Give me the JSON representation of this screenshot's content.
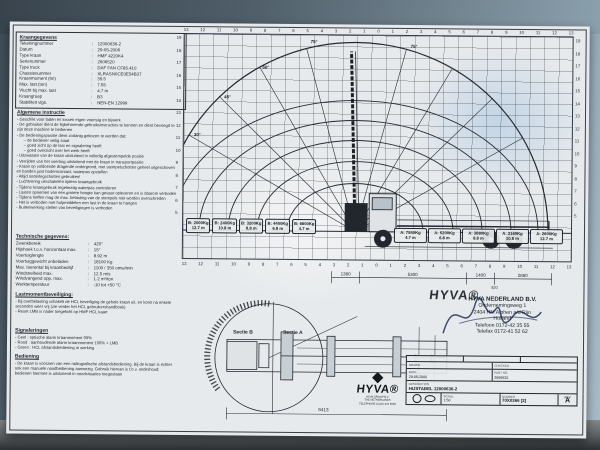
{
  "sheet": {
    "kraangegevens": {
      "title": "Kraangegevens",
      "rows": [
        {
          "label": "Tekeningnummer",
          "value": "12000636-2"
        },
        {
          "label": "Datum",
          "value": "29-05-2006"
        },
        {
          "label": "Type kraan",
          "value": "HMF 4220K4"
        },
        {
          "label": "Serienummer",
          "value": "2606520"
        },
        {
          "label": "Type truck",
          "value": "DAF FAN CF85.410"
        },
        {
          "label": "Chassisnummer",
          "value": "XLRASN0CE0E54B37"
        },
        {
          "label": "Kraanmoment (tm)",
          "value": "35.5"
        },
        {
          "label": "Max. last (ton)",
          "value": "7.55"
        },
        {
          "label": "Vlucht bij max. last",
          "value": "4.7 m"
        },
        {
          "label": "Kraangroep",
          "value": "B3"
        },
        {
          "label": "Stabiliteit vlgs.",
          "value": "NEN-EN 12999"
        }
      ]
    },
    "algemene_instructie": {
      "title": "Algemene instructie",
      "items": [
        {
          "text": "Geschikt voor laden en lossen eigen voertuig en bijwerk",
          "sub": false
        },
        {
          "text": "De gebruiker dient de bijbehorende gebruiksinstructies te kennen en dient bevoegd te zijn deze machine te bedienen",
          "sub": false
        },
        {
          "text": "De bedieningspositie dient zodanig gekozen te worden dat:",
          "sub": false
        },
        {
          "text": "de bediener veilig staat",
          "sub": true
        },
        {
          "text": "goed zicht op de last en signalering heeft",
          "sub": true
        },
        {
          "text": "goed overzicht over het werk heeft",
          "sub": true
        },
        {
          "text": "Uitzwaaien van de kraan uitsluitend in volledig afgestempelde positie",
          "sub": false
        },
        {
          "text": "Verrijden van het voertuig uitsluitend met de kraan in transportpositie",
          "sub": false
        },
        {
          "text": "Kraan op voldoende dragende ondergrond, met stempelschotten geheel uitgeschoven en banden juist bodemcontact, waterpas opstellen",
          "sub": false
        },
        {
          "text": "Altijd onderlegschotten gebruiken!",
          "sub": false
        },
        {
          "text": "Luchtvering uitschakelen tijdens kraangebruik",
          "sub": false
        },
        {
          "text": "Tijdens kraangebruik regelmatig waterpas controleren",
          "sub": false
        },
        {
          "text": "Lasten opnemen van een grotere hoogte kan gevaar opleveren en is daarom verboden",
          "sub": false
        },
        {
          "text": "Tijdens heffen mag de max. belasting van de stempels niet worden overschreden",
          "sub": false
        },
        {
          "text": "Het is verboden met hulpmiddelen een last in de kraan te hangen",
          "sub": false
        },
        {
          "text": "Buitenwerking stellen van beveiligingen is verboden",
          "sub": false
        }
      ]
    },
    "technische_gegevens": {
      "title": "Technische gegevens:",
      "rows": [
        {
          "label": "Zwenkbereik",
          "value": "420°"
        },
        {
          "label": "Hijshoek t.o.v. horizontaal max.",
          "value": "15°"
        },
        {
          "label": "Voertuiglengte",
          "value": "8.92 m"
        },
        {
          "label": "Voertuiggewicht onbeladen",
          "value": "18100 Kg"
        },
        {
          "label": "Max. toerental bij kraanbedrijf",
          "value": "1100 / 350 omw/min"
        },
        {
          "label": "Windsnelheid max.",
          "value": "12.5 m/s"
        },
        {
          "label": "Windvangend opp. max.",
          "value": "1.2 m²/ton"
        },
        {
          "label": "Werktemperatuur",
          "value": "-10 tot +50 °C"
        }
      ]
    },
    "lastmoment": {
      "title": "Lastmomentbeveiliging:",
      "items": [
        {
          "text": "Bij overbelasting schakelt de HCL beveiliging de gehele kraan uit, en komt na enkele seconden weer vrij (zie verder het HCL gebruikershandboek)",
          "sub": false
        },
        {
          "text": "Reset LMB is nader toegelicht op HMF HCL kaart",
          "sub": false
        }
      ]
    },
    "signaleringen": {
      "title": "Signaleringen",
      "items": [
        {
          "text": "Geel : optische alarm kraanmoment 90%",
          "sub": false
        },
        {
          "text": "Rood : aanhoudende alarm kraanmoment 100% + LMB",
          "sub": false
        },
        {
          "text": "Groen : HCL afstandsbediening in werking",
          "sub": false
        }
      ]
    },
    "bediening": {
      "title": "Bediening",
      "items": [
        {
          "text": "De kraan is voorzien van een radiografische afstandsbediening. Bij de kraan is echter ook een manuele noodbediening aanwezig. Gebruik hiervan is t.b.v. onderhoud; bedienen hiermee is uitsluitend in noodsituaties toegestaan",
          "sub": false
        }
      ]
    },
    "chart": {
      "scale_x": [
        "13",
        "12",
        "11",
        "10",
        "9",
        "8",
        "7",
        "6",
        "5",
        "4",
        "3",
        "2",
        "1",
        "0",
        "1",
        "2",
        "3",
        "4",
        "5",
        "6",
        "7",
        "8",
        "9",
        "10",
        "11",
        "12",
        "13"
      ],
      "scale_y": [
        "19",
        "18",
        "17",
        "16",
        "15",
        "14",
        "13",
        "12",
        "11",
        "10",
        "9",
        "8",
        "7",
        "6",
        "5"
      ],
      "angle_labels": [
        "30°",
        "45°",
        "60°",
        "75°",
        "75°"
      ],
      "capacity_b": [
        {
          "load": "B: 2000Kg",
          "reach": "12.7 m"
        },
        {
          "load": "B: 2400Kg",
          "reach": "10.8 m"
        },
        {
          "load": "B: 3200Kg",
          "reach": "8.8 m"
        },
        {
          "load": "B: 4400Kg",
          "reach": "6.8 m"
        },
        {
          "load": "B: 6600Kg",
          "reach": "4.7 m"
        }
      ],
      "capacity_a": [
        {
          "load": "A: 7550Kg",
          "reach": "4.7 m"
        },
        {
          "load": "A: 5200Kg",
          "reach": "6.8 m"
        },
        {
          "load": "A: 3880Kg",
          "reach": "8.8 m"
        },
        {
          "load": "A: 3160Kg",
          "reach": "10.8 m"
        },
        {
          "load": "A: 2600Kg",
          "reach": "12.7 m"
        }
      ],
      "dims_side": {
        "d1": "1380",
        "d2": "5300",
        "d3": "1400",
        "d4": "2860",
        "d5": "820"
      }
    },
    "top_view": {
      "sectie_b": "Sectie B",
      "sectie_a": "Sectie A",
      "dim_total": "8413",
      "dim_r1": "7100",
      "dim_r2": "3600"
    },
    "address": {
      "company": "HYVA NEDERLAND B.V.",
      "logo": "HYVA®",
      "lines": [
        {
          "text": "Ondernemingsweg 1",
          "sub": false
        },
        {
          "text": "2404 HM Alphen a/d Rijn",
          "sub": false
        },
        {
          "text": "Holland",
          "sub": false
        },
        {
          "text": "Telefoon 0172-42 35 55",
          "sub": false
        },
        {
          "text": "Telefax 0172-41 52 62",
          "sub": false
        }
      ]
    },
    "logo_block": {
      "brand": "HYVA®",
      "sub1": "HYVA GROUP B.V.",
      "sub2": "THE NETHERLANDS",
      "sub3": "TELEPHONE (31)10 419 6666"
    },
    "titleblock": {
      "drawn_label": "DRAWN",
      "checked_label": "CHECKED",
      "date_label": "DATE",
      "date": "29-05-2006",
      "part_label": "PART NO.",
      "part_no": "2606520",
      "desc_label": "DESCRIPTION",
      "description": "HIJSTABEL 12000636-2",
      "projection_label": "PROJECTION",
      "scale_label": "SCALE",
      "scale": "1:50",
      "number_label": "NUMBER",
      "number": "70X0366 [2]",
      "rev_label": "REV",
      "rev": "A"
    }
  },
  "chart_data": {
    "type": "table",
    "title": "HMF 4220K4 hijstabel (load chart)",
    "series": [
      {
        "name": "A",
        "reach_m": [
          4.7,
          6.8,
          8.8,
          10.8,
          12.7
        ],
        "capacity_kg": [
          7550,
          5200,
          3880,
          3160,
          2600
        ]
      },
      {
        "name": "B",
        "reach_m": [
          4.7,
          6.8,
          8.8,
          10.8,
          12.7
        ],
        "capacity_kg": [
          6600,
          4400,
          3200,
          2400,
          2000
        ]
      }
    ],
    "boom_angle_lines_deg": [
      30,
      45,
      60,
      75
    ],
    "x_range_m": [
      -13,
      13
    ],
    "y_range_m": [
      0,
      19
    ],
    "grid": true
  }
}
